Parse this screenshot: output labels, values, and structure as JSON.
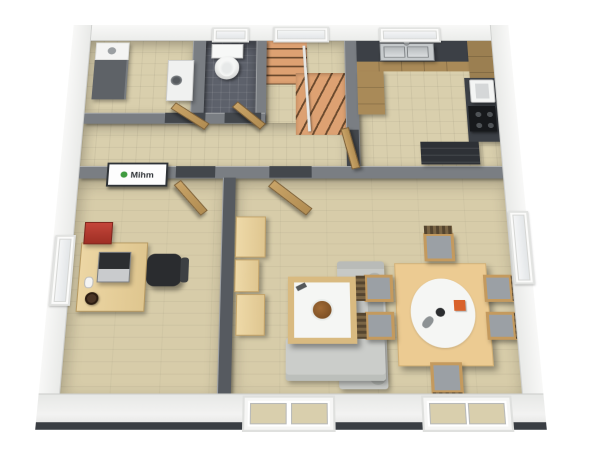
{
  "scene": {
    "type": "3d-floorplan-rendering",
    "view": "birdseye-cutaway",
    "logo": {
      "text": "Mihm",
      "icon": "green-builder-logo-icon"
    }
  },
  "rooms": [
    {
      "id": "utility-room",
      "objects": [
        "tall-cabinet",
        "washing-machine-counter"
      ]
    },
    {
      "id": "wc-bathroom",
      "objects": [
        "toilet",
        "back-window"
      ]
    },
    {
      "id": "stair-hall",
      "objects": [
        "winder-staircase",
        "railing",
        "back-window"
      ]
    },
    {
      "id": "kitchen",
      "objects": [
        "counter-with-double-sink",
        "back-window",
        "tall-cabinet",
        "coffee-machine",
        "cooktop",
        "dark-sideboard"
      ]
    },
    {
      "id": "hallway",
      "objects": [
        "utility-door",
        "wc-door",
        "kitchen-door"
      ]
    },
    {
      "id": "office",
      "objects": [
        "desk",
        "laptop",
        "office-chair",
        "red-printer",
        "mug",
        "mouse",
        "wall-sign",
        "side-window",
        "door"
      ]
    },
    {
      "id": "living-dining-room",
      "objects": [
        "wall-unit",
        "corner-sofa",
        "coffee-table",
        "dining-table",
        "six-chairs",
        "oval-rug",
        "side-window",
        "front-windows",
        "door"
      ]
    }
  ],
  "colors": {
    "plinth": "#3a3e43",
    "int_wall": "#7a7e83",
    "int_wall_dark": "#565a60",
    "tile_floor": "#d9cfad",
    "laminate": "#d7cca9",
    "wc_floor": "#5d616b",
    "stair_tread": "#dda172",
    "stair_nosing": "#6a492d",
    "wood_cabinet": "#a98a58",
    "counter_dark": "#3c4046",
    "steel": "#c6cacc",
    "appliance_white": "#f0f1f0",
    "cabinet_gray": "#5e6267",
    "door_wood": "#c8a367",
    "chair_black": "#2a2c2f",
    "sofa_gray": "#c7c9c6",
    "cushion_gray": "#b0b3af",
    "table_wood": "#eccb92",
    "chair_wood": "#c49a5e",
    "seat_gray": "#9ba0a5",
    "dark_shelf": "#2e3136",
    "rug_white": "#f5f6f4",
    "logo_green": "#3f9b3f",
    "printer_red": "#b63a2c",
    "accent_orange": "#d9622b"
  }
}
